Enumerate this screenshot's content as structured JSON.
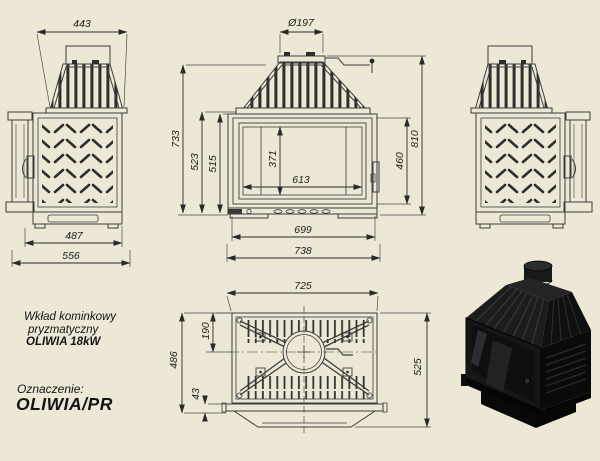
{
  "title_block": {
    "product_line1": "Wkład kominkowy",
    "product_line2": "pryzmatyczny",
    "product_line3": "OLIWIA 18kW",
    "designation_label": "Oznaczenie:",
    "designation_value": "OLIWIA/PR"
  },
  "dimensions": {
    "side": {
      "depth_top": "443",
      "depth_base": "487",
      "depth_total": "556"
    },
    "front": {
      "flue_diameter": "Ø197",
      "height_to_hood_top": "733",
      "height_body": "523",
      "height_inner": "515",
      "glass_height": "371",
      "glass_width": "613",
      "door_height": "460",
      "height_total": "810",
      "width_inner": "699",
      "width_total": "738"
    },
    "top": {
      "width": "725",
      "flue_center_offset": "190",
      "depth_body": "486",
      "front_lip": "43",
      "depth_total": "525"
    }
  },
  "colors": {
    "background": "#ECE8D5",
    "ink": "#2A2A2A",
    "rib": "#2E2E2E",
    "render_body": "#141414"
  }
}
